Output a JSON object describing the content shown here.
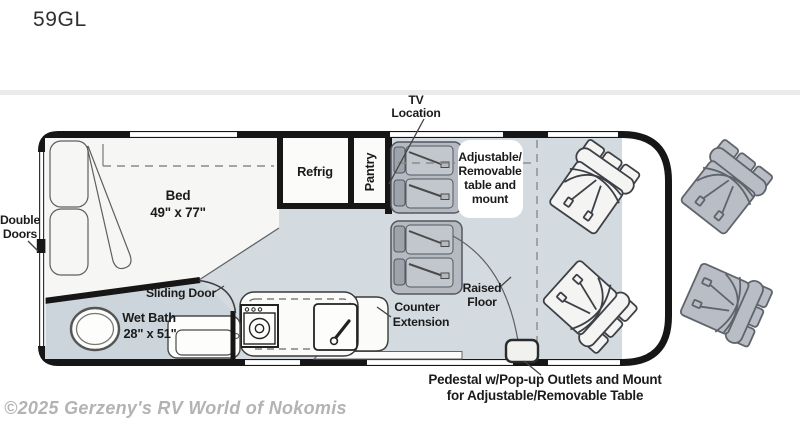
{
  "header": {
    "title": "59GL"
  },
  "floorplan": {
    "exterior": {
      "double_doors": [
        "Double",
        "Doors"
      ]
    },
    "bedroom": {
      "bed_label": "Bed",
      "bed_size": "49\" x 77\""
    },
    "kitchen": {
      "refrig": "Refrig",
      "pantry": "Pantry",
      "counter_extension": [
        "Counter",
        "Extension"
      ]
    },
    "bath": {
      "label": "Wet Bath",
      "size": "28\" x 51\"",
      "sliding_door": "Sliding Door"
    },
    "living": {
      "tv_location": [
        "TV",
        "Location"
      ],
      "table_note": [
        "Adjustable/",
        "Removable",
        "table and",
        "mount"
      ],
      "raised_floor": [
        "Raised",
        "Floor"
      ],
      "pedestal_note": [
        "Pedestal w/Pop-up Outlets and Mount",
        "for Adjustable/Removable Table"
      ]
    },
    "colors": {
      "wall": "#161616",
      "floor": "#d3dbe1",
      "wet_bath_floor": "#ccd5db",
      "bed": "#f6f6f4",
      "fixture_white": "#fbfbfa",
      "bench": "#b5bac2",
      "bench_headrest": "#9da3ab",
      "bench_cushion": "#c2c7ce",
      "chair_inside": "#f4f4f2",
      "chair_outside": "#b9bdc6",
      "divider": "#ebebeb"
    }
  },
  "footer": {
    "copyright": "©2025 Gerzeny's RV World of Nokomis"
  }
}
